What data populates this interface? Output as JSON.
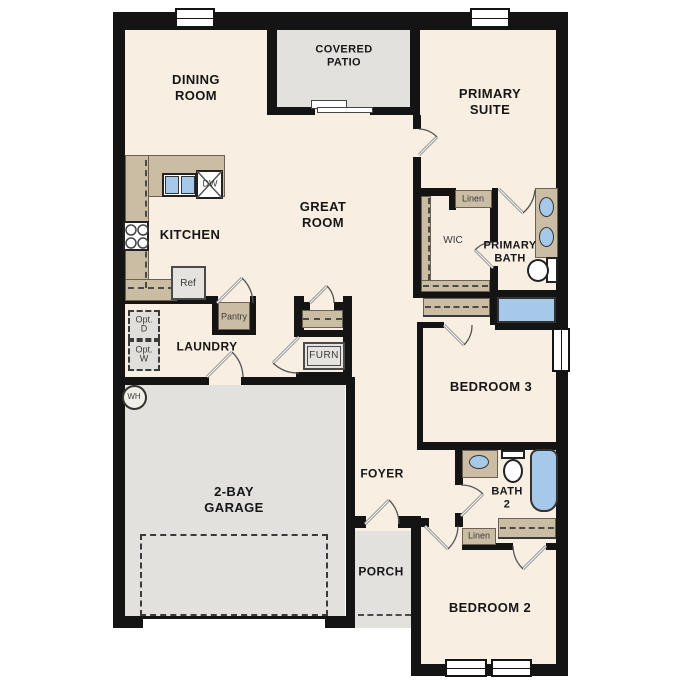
{
  "plan_title": "single-story floor plan",
  "colors": {
    "wall": "#141414",
    "floor": "#f8eee1",
    "outdoor_concrete": "#e2e1dd",
    "cabinet_tan": "#cbbda4",
    "water_blue": "#a7c9e9",
    "appliance_gray": "#e4e3df"
  },
  "rooms": {
    "dining": {
      "line1": "DINING",
      "line2": "ROOM"
    },
    "covered_patio": {
      "line1": "COVERED",
      "line2": "PATIO"
    },
    "primary_suite": {
      "line1": "PRIMARY",
      "line2": "SUITE"
    },
    "great_room": {
      "line1": "GREAT",
      "line2": "ROOM"
    },
    "kitchen": {
      "label": "KITCHEN"
    },
    "wic": {
      "label": "WIC"
    },
    "primary_bath": {
      "line1": "PRIMARY",
      "line2": "BATH"
    },
    "laundry": {
      "label": "LAUNDRY"
    },
    "bedroom3": {
      "label": "BEDROOM 3"
    },
    "garage": {
      "line1": "2-BAY",
      "line2": "GARAGE"
    },
    "foyer": {
      "label": "FOYER"
    },
    "bath2": {
      "line1": "BATH",
      "line2": "2"
    },
    "porch": {
      "label": "PORCH"
    },
    "bedroom2": {
      "label": "BEDROOM 2"
    }
  },
  "fixtures": {
    "dishwasher": "DW",
    "refrigerator": "Ref",
    "pantry": "Pantry",
    "furnace": "FURN",
    "opt_dryer": {
      "line1": "Opt.",
      "line2": "D"
    },
    "opt_washer": {
      "line1": "Opt.",
      "line2": "W"
    },
    "water_heater": "WH",
    "linen_primary": "Linen",
    "linen_hall": "Linen"
  }
}
